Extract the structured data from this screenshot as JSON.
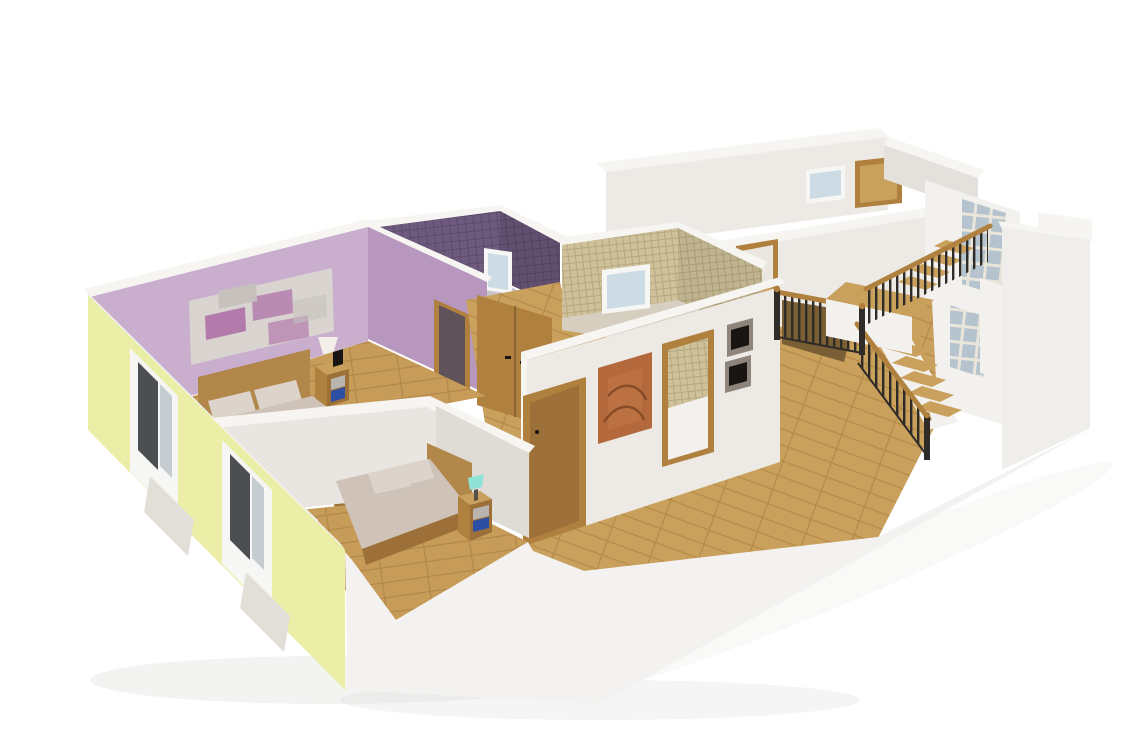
{
  "scene": {
    "title": "3D Cutaway Floor Plan Render",
    "style": "isometric dollhouse view of an upper storey on a white background",
    "rooms": [
      {
        "name": "master bedroom",
        "walls": "lavender purple",
        "floor": "wood planks",
        "furniture": [
          "double bed with beige duvet and two pillows",
          "wooden headboard",
          "nightstand with grey and blue drawers",
          "wall lamp with white shade",
          "abstract collage wall art"
        ]
      },
      {
        "name": "second bedroom",
        "walls": "white and pale grey",
        "floor": "wood planks",
        "furniture": [
          "single bed with beige duvet and two pillows",
          "wooden headboard",
          "nightstand with grey and blue drawers",
          "teal table lamp"
        ]
      },
      {
        "name": "bathroom dark purple",
        "walls": "dark purple mosaic tile",
        "fixtures": [
          "white framed window"
        ]
      },
      {
        "name": "bathroom beige",
        "walls": "beige mosaic tile",
        "fixtures": [
          "white framed window"
        ]
      },
      {
        "name": "hallway",
        "walls": "white",
        "decor": [
          "orange abstract painting",
          "two dark framed pictures",
          "wooden wardrobe doors",
          "wooden doors with frames"
        ]
      },
      {
        "name": "upper room",
        "walls": "white",
        "fixtures": [
          "small window",
          "wooden doorway"
        ]
      },
      {
        "name": "stairwell",
        "features": [
          "L-shaped wooden staircase",
          "black metal balustrade with wooden handrail",
          "glass block wall",
          "mid landing"
        ]
      }
    ],
    "exterior": {
      "left_wall": "pale yellow with cut window openings and marble sills",
      "right_wall": "plain white",
      "front": "cut-away white slab edge"
    }
  },
  "colors": {
    "bg": "#ffffff",
    "cut": "#f6f5f2",
    "wall_white": "#edeae6",
    "wall_bright": "#f3f1ee",
    "wall_shade": "#e4e0db",
    "wall_divider": "#e9e6e1",
    "wall_divider_shade": "#dfdbd5",
    "band_front": "#f3f2f0",
    "east_wall": "#efeeea",
    "yellow": "#ebeea6",
    "lavender": "#c9aecd",
    "lavender_shade": "#b797be",
    "tile_dark": "#6e5a7e",
    "tile_dark_line": "#5c4b6b",
    "tile_beige": "#cfc29b",
    "tile_beige_line": "#b6a87e",
    "bath_floor_purple": "#c9c2cd",
    "bath_floor_beige": "#d6cfc0",
    "wood": "#b0803e",
    "wood_mid": "#9c7038",
    "wood_dark": "#7a5a2c",
    "wood_light": "#c9a05c",
    "wood_bed": "#b2874a",
    "floor_wood": "#c79b58",
    "floor_wood_line": "#b2874a",
    "floor_wood_hall": "#c9a05c",
    "floor_wood_hall_line": "#b58a48",
    "stair_hole": "#7a5e34",
    "bedding": "#cfc3b9",
    "pillow": "#dcd3ca",
    "crease": "#b8aca1",
    "rail_black": "#2f2b27",
    "glass_block": "#b4c3ce",
    "glass_grout": "#e9e5db",
    "win_frame": "#f6f6f4",
    "win_glass_dark": "#4b4f52",
    "win_glass_light": "#c6cdd1",
    "win_sky": "#ccdbe4",
    "drawer_blue": "#2c4fa3",
    "drawer_gray": "#b9b5ae",
    "lamp_teal": "#8fe3d6",
    "lamp_shade": "#f2efe8",
    "lamp_stem": "#55504a",
    "art_orange": "#b4693c",
    "art_orange_light": "#c47a48",
    "art_orange_deep": "#7c4423",
    "frame_gray": "#8d857c",
    "frame_black": "#181512",
    "collage_bg": "#d9d4d0",
    "collage_purple": "#ab6ba5",
    "collage_gray": "#c6c1bd",
    "sill_marble": "#e2dfd8",
    "open_dark": "#5f5258",
    "open_light": "#eae6e0",
    "shadow": "#dcdcda"
  }
}
